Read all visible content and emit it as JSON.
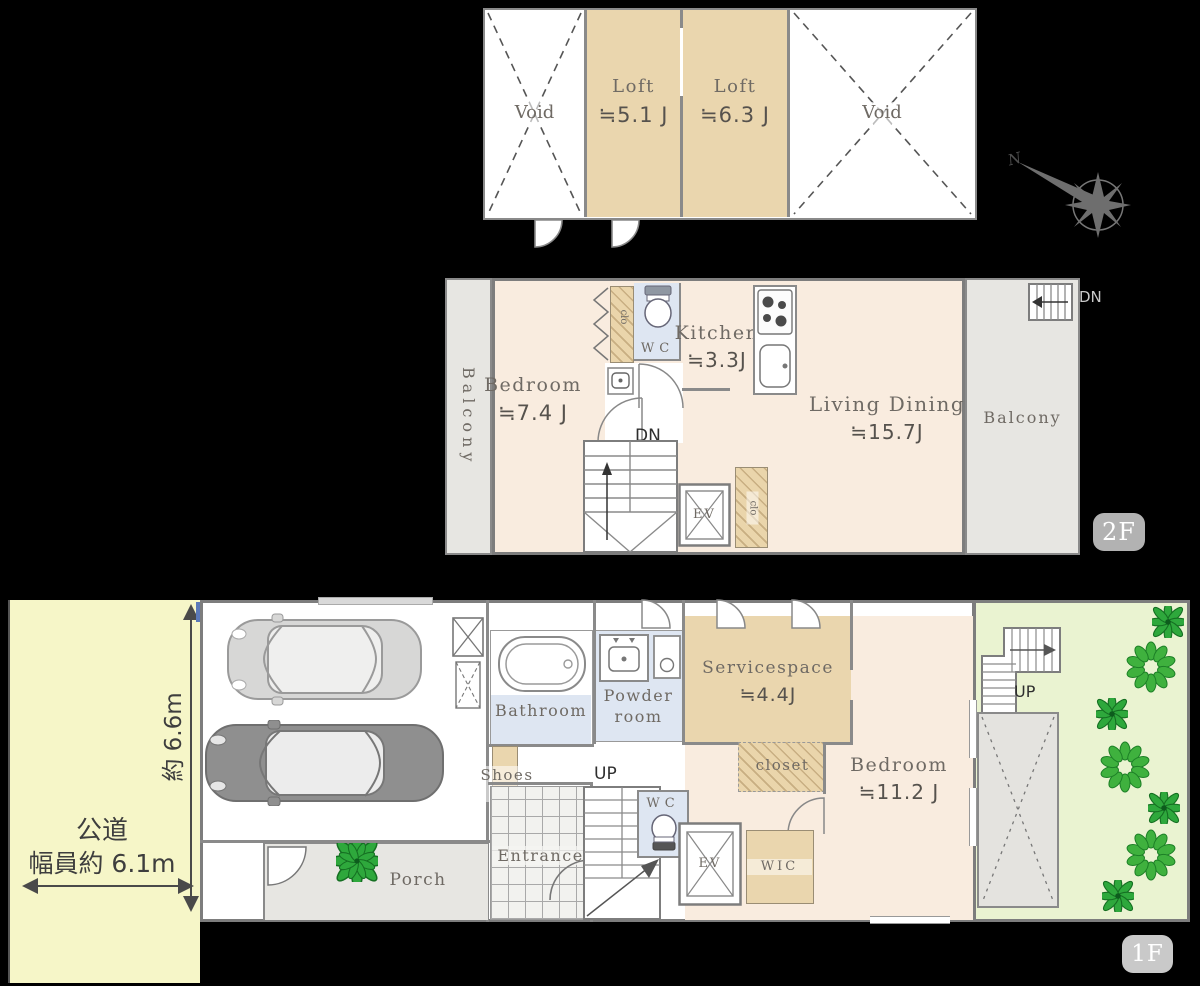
{
  "loft": {
    "void_left": "Void",
    "void_right": "Void",
    "rooms": [
      {
        "name": "Loft",
        "area": "≒5.1 J"
      },
      {
        "name": "Loft",
        "area": "≒6.3 J"
      }
    ]
  },
  "compass": {
    "north": "N"
  },
  "floor2": {
    "badge": "2F",
    "balcony_left": "Balcony",
    "balcony_right": "Balcony",
    "bedroom": {
      "name": "Bedroom",
      "area": "≒7.4 J"
    },
    "kitchen": {
      "name": "Kitchen",
      "area": "≒3.3J"
    },
    "living": {
      "name": "Living Dining",
      "area": "≒15.7J"
    },
    "wc": "WC",
    "closet_upper": "clo",
    "closet_lower": "clo",
    "elevator": "EV",
    "stairs_down": "DN",
    "stairs_down_ext": "DN"
  },
  "floor1": {
    "badge": "1F",
    "bathroom": "Bathroom",
    "powder_room": [
      "Powder",
      "room"
    ],
    "servicespace": {
      "name": "Servicespace",
      "area": "≒4.4J"
    },
    "closet": "closet",
    "bedroom": {
      "name": "Bedroom",
      "area": "≒11.2 J"
    },
    "shoes_closet": [
      "Shoes",
      "clo"
    ],
    "entrance": "Entrance",
    "porch": "Porch",
    "wc": "WC",
    "elevator": "EV",
    "wic": "WIC",
    "stairs_up_main": "UP",
    "stairs_up_garden": "UP"
  },
  "site": {
    "road_name": "公道",
    "road_width": "幅員約 6.1m",
    "site_depth": "約 6.6m"
  },
  "colors": {
    "room_cream": "#f9ecdf",
    "loft_tan": "#ead6ae",
    "wet_blue": "#dee6f2",
    "balcony_gray": "#e7e6e2",
    "garden_green": "#eaf3d1",
    "road_yellow": "#f6f6c8",
    "wall_gray": "#7d7d7d",
    "badge_gray": "#b2b2b2",
    "plant_green": "#3fb13e"
  }
}
